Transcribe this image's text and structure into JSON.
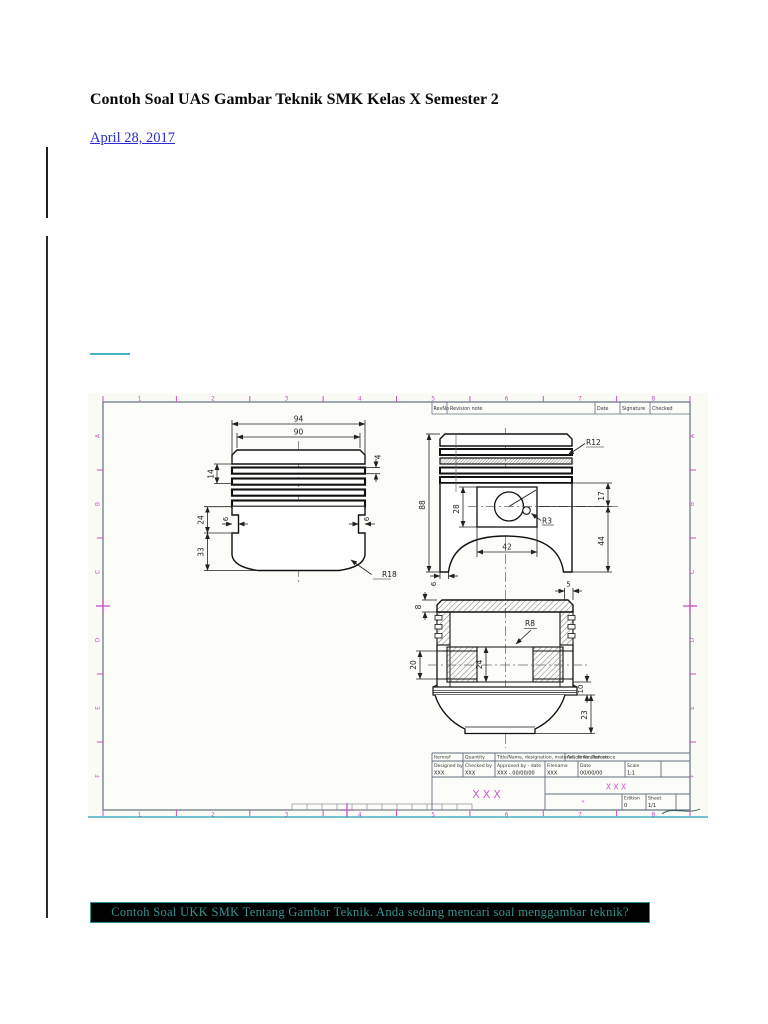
{
  "page": {
    "title": "Contoh Soal UAS Gambar Teknik SMK Kelas X Semester 2",
    "date": "April 28, 2017",
    "footer": "Contoh Soal UKK SMK Tentang Gambar Teknik. Anda sedang mencari soal menggambar teknik?"
  },
  "colors": {
    "link_blue": "#2b2bd6",
    "ruler_magenta": "#c94fc9",
    "placeholder_magenta": "#cf5ccf",
    "footer_teal": "#36948f",
    "footer_bg": "#010101",
    "teal_rule": "#46b1c3"
  },
  "drawing": {
    "ruler": {
      "top": [
        "1",
        "2",
        "3",
        "4",
        "5",
        "6",
        "7",
        "8"
      ],
      "bottom": [
        "1",
        "2",
        "3",
        "4",
        "5",
        "6",
        "7",
        "8"
      ],
      "left": [
        "A",
        "B",
        "C",
        "D",
        "E",
        "F"
      ],
      "right": [
        "A",
        "B",
        "C",
        "D",
        "E",
        "F"
      ]
    },
    "revision": {
      "rev": "RevNo",
      "note": "Revision note",
      "date": "Date",
      "signature": "Signature",
      "checked": "Checked"
    },
    "front": {
      "d94": "94",
      "d90": "90",
      "d4": "4",
      "d14": "14",
      "d24": "24",
      "d33": "33",
      "d6l": "6",
      "d6r": "6",
      "r18": "R18"
    },
    "side": {
      "d88": "88",
      "d28": "28",
      "d42": "42",
      "r12": "R12",
      "d17": "17",
      "d44": "44",
      "r3": "R3",
      "d6": "6"
    },
    "section": {
      "d8": "8",
      "d5": "5",
      "r8": "R8",
      "d20": "20",
      "d24": "24",
      "d10": "10",
      "d23": "23"
    },
    "title_block": {
      "headers": [
        "Itemref",
        "Quantity",
        "Title/Name, designation, material, dimension etc",
        "Article No./Reference"
      ],
      "fields": [
        {
          "label": "Designed by",
          "value": "XXX"
        },
        {
          "label": "Checked by",
          "value": "XXX"
        },
        {
          "label": "Approved by - date",
          "value": "XXX - 00/00/00"
        },
        {
          "label": "Filename",
          "value": "XXX"
        },
        {
          "label": "Date",
          "value": "00/00/00"
        },
        {
          "label": "Scale",
          "value": "1:1"
        }
      ],
      "big_placeholder": "XXX",
      "right_placeholder": "XXX",
      "star": "*",
      "edition_label": "Edition",
      "edition_value": "0",
      "sheet_label": "Sheet",
      "sheet_value": "1/1"
    }
  }
}
